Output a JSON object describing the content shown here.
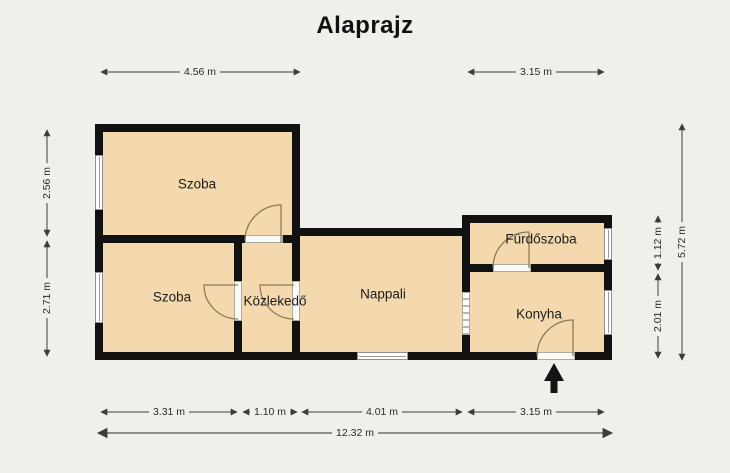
{
  "title": "Alaprajz",
  "rooms": {
    "szoba1": {
      "label": "Szoba"
    },
    "szoba2": {
      "label": "Szoba"
    },
    "kozlekedo": {
      "label": "Közlekedő"
    },
    "nappali": {
      "label": "Nappali"
    },
    "furdoszoba": {
      "label": "Fürdőszoba"
    },
    "konyha": {
      "label": "Konyha"
    }
  },
  "dims": {
    "top_left": "4.56 m",
    "top_right": "3.15 m",
    "left_upper": "2.56 m",
    "left_lower": "2.71 m",
    "right_bathroom": "1.12 m",
    "right_kitchen": "2.01 m",
    "right_total": "5.72 m",
    "bottom_room": "3.31 m",
    "bottom_hall": "1.10 m",
    "bottom_living": "4.01 m",
    "bottom_kitchen": "3.15 m",
    "bottom_total": "12.32 m"
  },
  "icons": {
    "entrance_arrow": "up-arrow"
  },
  "colors": {
    "background": "#f0efea",
    "wall": "#111111",
    "room_fill": "#f3d9ad",
    "door_arc": "#8b7b5a",
    "dimension_line": "#3c3c3c"
  }
}
